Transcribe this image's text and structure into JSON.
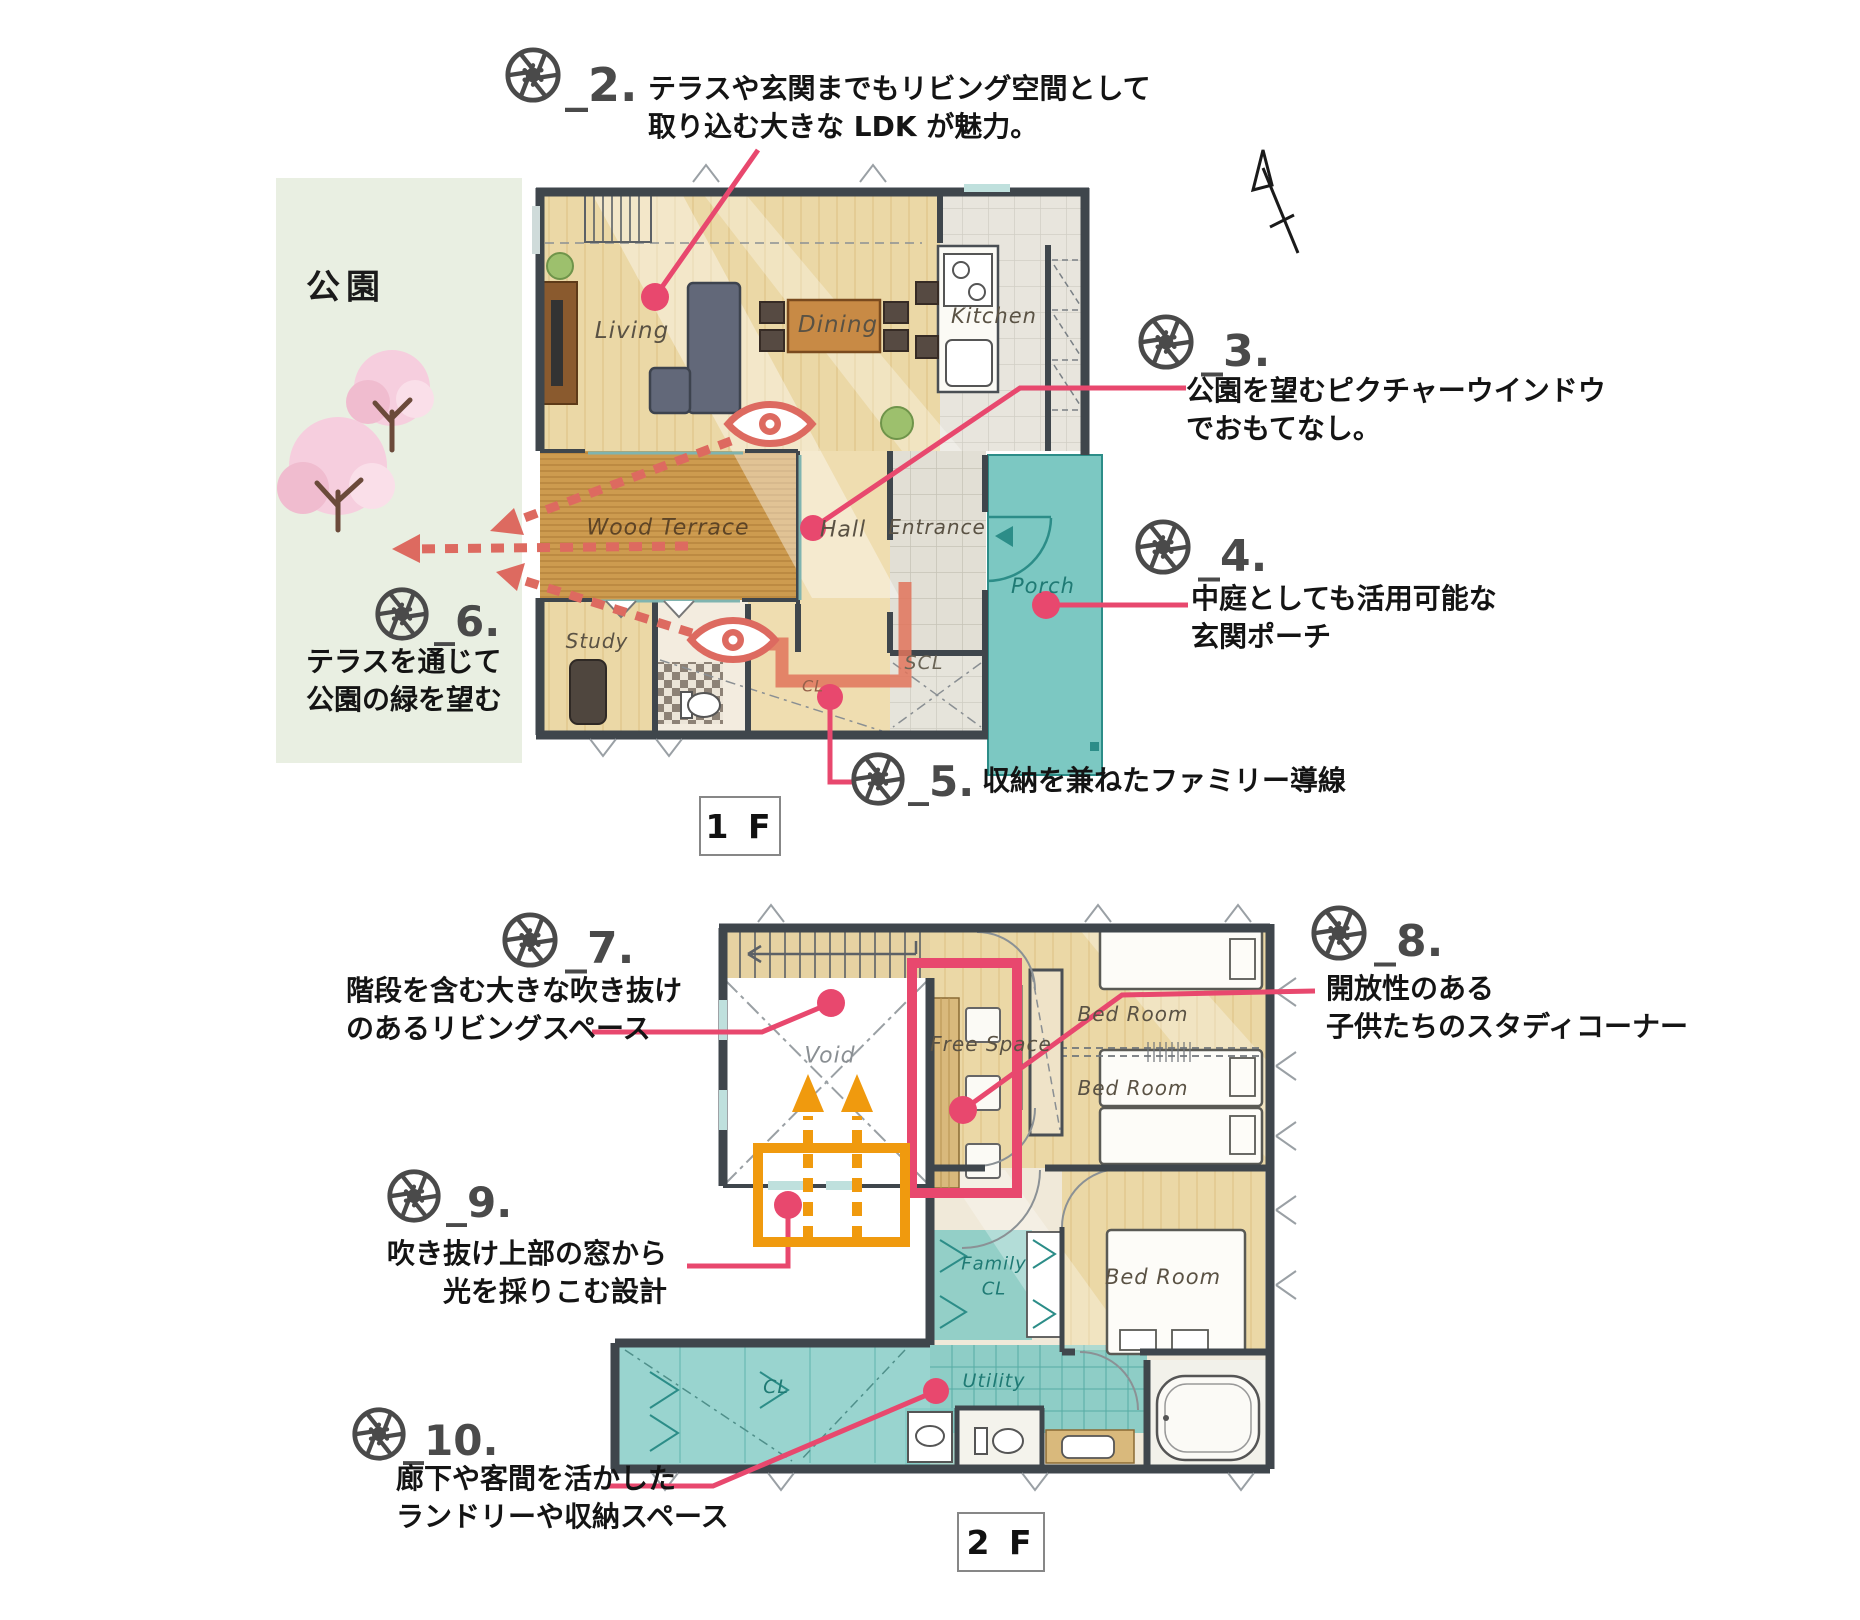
{
  "park": {
    "label": "公園"
  },
  "floor_badges": {
    "f1": "1 F",
    "f2": "2 F"
  },
  "annotations": [
    {
      "number": "_2.",
      "lines": [
        "テラスや玄関までもリビング空間として",
        "取り込む大きな LDK が魅力。"
      ]
    },
    {
      "number": "_3.",
      "lines": [
        "公園を望むピクチャーウインドウ",
        "でおもてなし。"
      ]
    },
    {
      "number": "_4.",
      "lines": [
        "中庭としても活用可能な",
        "玄関ポーチ"
      ]
    },
    {
      "number": "_5.",
      "lines": [
        "収納を兼ねたファミリー導線"
      ]
    },
    {
      "number": "_6.",
      "lines": [
        "テラスを通じて",
        "公園の緑を望む"
      ]
    },
    {
      "number": "_7.",
      "lines": [
        "階段を含む大きな吹き抜け",
        "のあるリビングスペース"
      ]
    },
    {
      "number": "_8.",
      "lines": [
        "開放性のある",
        "子供たちのスタディコーナー"
      ]
    },
    {
      "number": "_9.",
      "lines": [
        "吹き抜け上部の窓から",
        "光を採りこむ設計"
      ]
    },
    {
      "number": "_10.",
      "lines": [
        "廊下や客間を活かした",
        "ランドリーや収納スペース"
      ]
    }
  ],
  "rooms_1f": {
    "living": "Living",
    "dining": "Dining",
    "kitchen": "Kitchen",
    "wood_terrace": "Wood Terrace",
    "hall": "Hall",
    "entrance": "Entrance",
    "porch": "Porch",
    "study": "Study",
    "scl": "SCL",
    "cl": "CL"
  },
  "rooms_2f": {
    "void": "Void",
    "free_space": "Free Space",
    "bed_room": "Bed Room",
    "family_cl_line1": "Family",
    "family_cl_line2": "CL",
    "cl": "CL",
    "utility": "Utility"
  },
  "colors": {
    "leader_pink": "#e8486e",
    "highlight_orange": "#f09a0e",
    "flow_salmon": "#e0745c",
    "eye_red": "#dd6a60",
    "room_teal": "#7cc8c2",
    "park_green": "#e9efe2",
    "icon_gray": "#4a4a4a",
    "wall": "#3f464c",
    "wood": "#ebd8a6",
    "terrace_wood": "#cd9b4f"
  }
}
